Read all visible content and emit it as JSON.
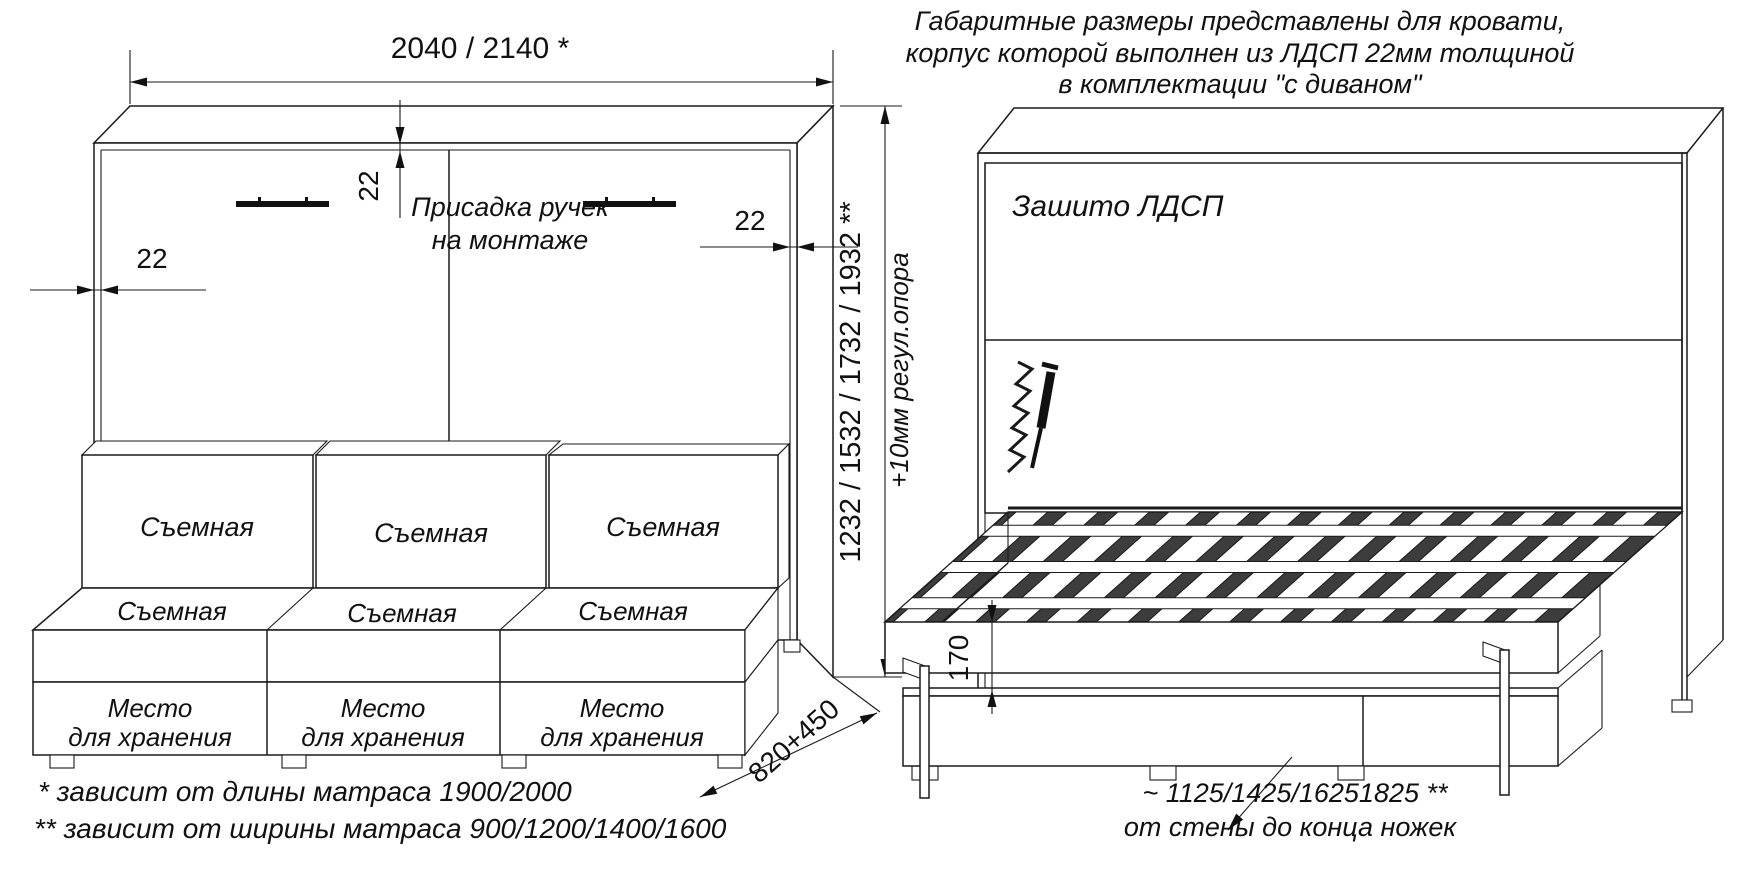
{
  "header_note": {
    "line1": "Габаритные размеры представлены для кровати,",
    "line2": "корпус которой выполнен из ЛДСП 22мм толщиной",
    "line3": "в комплектации \"с диваном\""
  },
  "front_view": {
    "width_dim": "2040 / 2140 *",
    "thickness_top": "22",
    "thickness_left": "22",
    "thickness_right": "22",
    "handles_note_line1": "Присадка ручек",
    "handles_note_line2": "на монтаже",
    "height_dim": "1232 / 1532 / 1732 / 1932 **",
    "height_dim_note": "+10мм регул.опора",
    "depth_dim": "820+450",
    "sofa": {
      "back_cushions": [
        "Съемная",
        "Съемная",
        "Съемная"
      ],
      "seat_cushions": [
        "Съемная",
        "Съемная",
        "Съемная"
      ],
      "storage_boxes": [
        {
          "line1": "Место",
          "line2": "для хранения"
        },
        {
          "line1": "Место",
          "line2": "для хранения"
        },
        {
          "line1": "Место",
          "line2": "для хранения"
        }
      ]
    }
  },
  "open_view": {
    "panel_note": "Зашито ЛДСП",
    "frame_height_dim": "170",
    "legs_dim_line1": "~ 1125/1425/16251825 **",
    "legs_dim_line2": "от стены до конца ножек"
  },
  "footnotes": {
    "line1": "*  зависит от длины матраса 1900/2000",
    "line2": "** зависит от ширины матраса 900/1200/1400/1600"
  },
  "colors": {
    "line": "#1a1a1a",
    "background": "#ffffff",
    "slat_shadow": "#3d3d3d"
  }
}
